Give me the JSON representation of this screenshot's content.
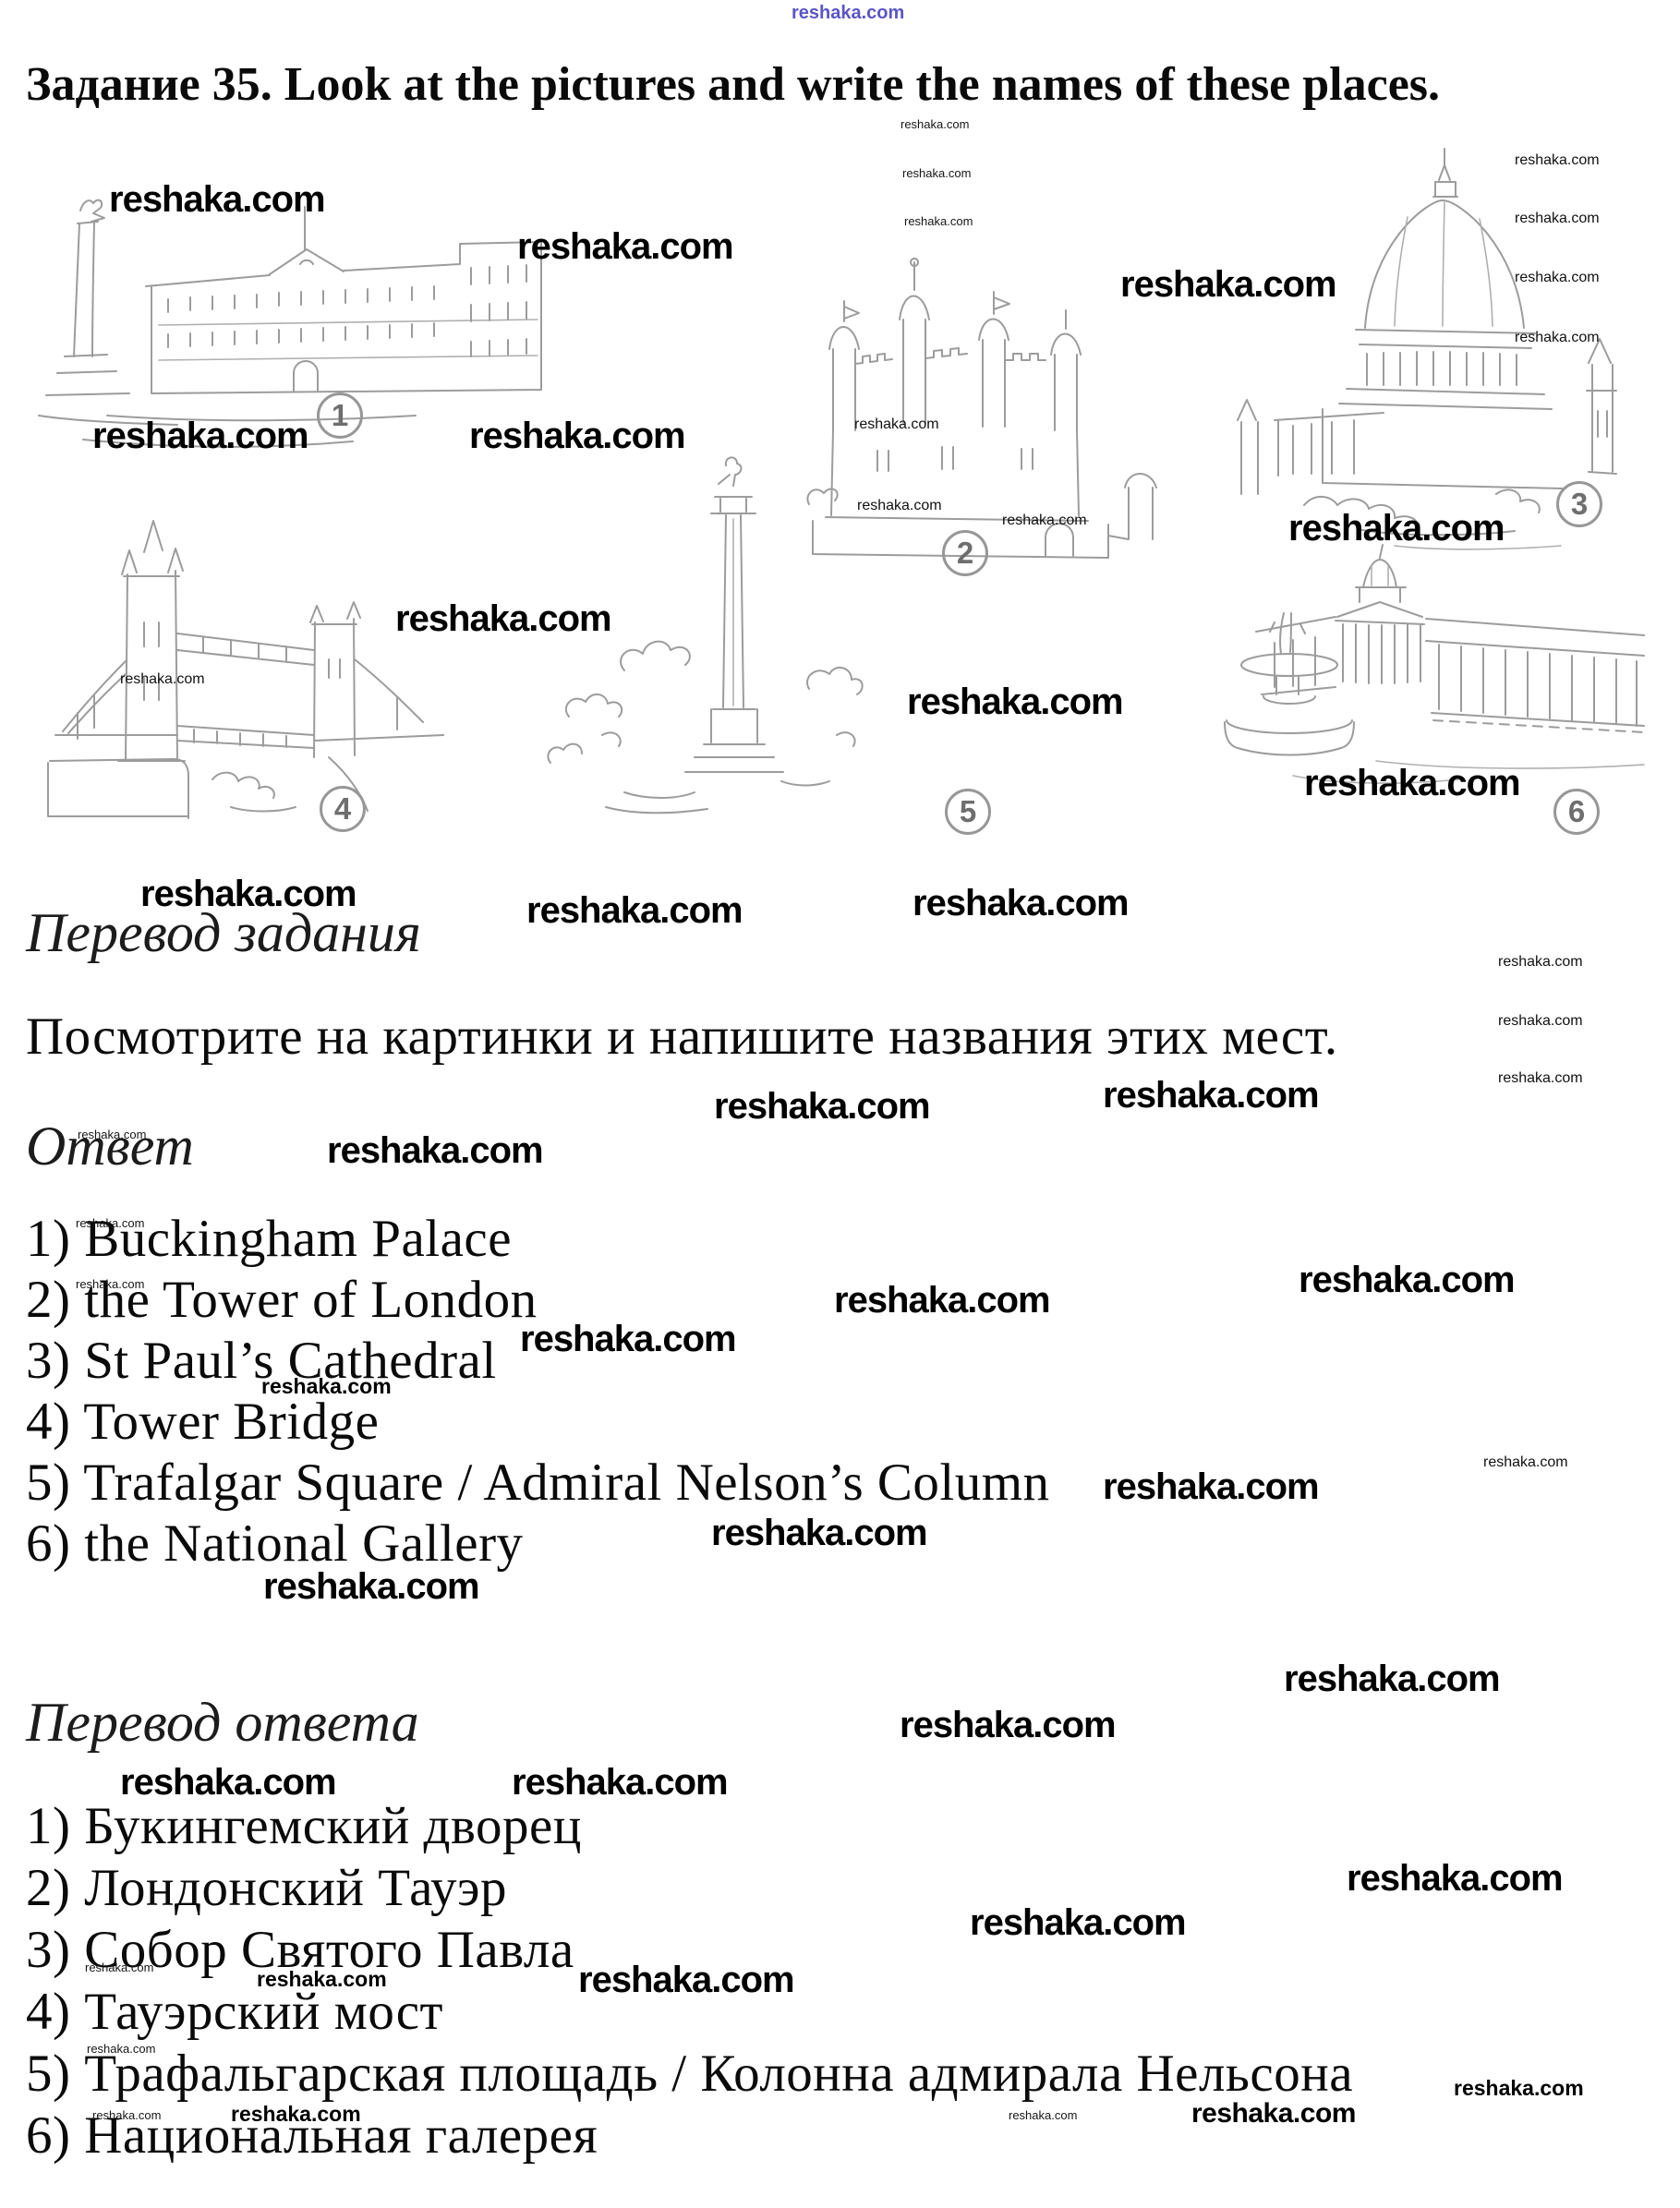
{
  "watermark": {
    "text": "reshaka.com",
    "brand_blue": "#5a55c8"
  },
  "title": "Задание 35. Look at the pictures and write the names of these places.",
  "sections": {
    "translation_task_heading": "Перевод задания",
    "translation_task_text": "Посмотрите на картинки и напишите названия этих мест.",
    "answer_heading": "Ответ",
    "translation_answer_heading": "Перевод ответа"
  },
  "figures": [
    {
      "num": "1"
    },
    {
      "num": "2"
    },
    {
      "num": "3"
    },
    {
      "num": "4"
    },
    {
      "num": "5"
    },
    {
      "num": "6"
    }
  ],
  "answers_en": [
    "1) Buckingham Palace",
    "2) the Tower of London",
    "3) St Paul’s Cathedral",
    "4) Tower Bridge",
    "5) Trafalgar Square / Admiral Nelson’s Column",
    "6) the National Gallery"
  ],
  "answers_ru": [
    "1) Букингемский дворец",
    "2) Лондонский Тауэр",
    "3) Собор Святого Павла",
    "4) Тауэрский мост",
    "5) Трафальгарская площадь / Колонна адмирала Нельсона",
    "6) Национальная галерея"
  ]
}
